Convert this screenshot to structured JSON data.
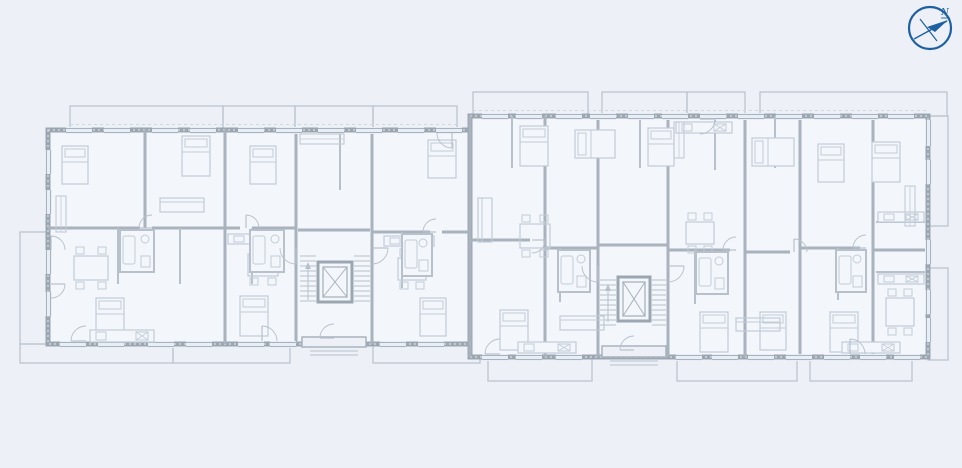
{
  "compass": {
    "label": "N"
  },
  "colors": {
    "bg": "#edf1f7",
    "room": "#f3f6fb",
    "wallOuter": "#9ca6b1",
    "wallInner": "#a9b2bd",
    "partition": "#b7c0cb",
    "furniture": "#c3ccd7",
    "balcony": "#b9c1cc",
    "windowFill": "#e8eef5",
    "windowLine": "#a9b2bd",
    "dash": "#cfd7e0",
    "stair": "#b7c0cb",
    "compass": "#1e5fa2"
  },
  "plan": {
    "wings": [
      {
        "x": 48,
        "y": 130,
        "w": 422,
        "h": 214
      },
      {
        "x": 470,
        "y": 116,
        "w": 458,
        "h": 241
      }
    ],
    "balconies": [
      [
        70,
        106,
        153,
        24
      ],
      [
        223,
        106,
        72,
        24
      ],
      [
        295,
        106,
        78,
        24
      ],
      [
        373,
        106,
        84,
        24
      ],
      [
        473,
        92,
        115,
        24
      ],
      [
        602,
        92,
        85,
        24
      ],
      [
        687,
        92,
        58,
        24
      ],
      [
        760,
        92,
        187,
        24
      ],
      [
        928,
        116,
        20,
        110
      ],
      [
        928,
        268,
        20,
        92
      ],
      [
        20,
        344,
        153,
        19
      ],
      [
        173,
        344,
        117,
        19
      ],
      [
        373,
        344,
        107,
        19
      ],
      [
        20,
        232,
        28,
        112
      ],
      [
        488,
        357,
        104,
        24
      ],
      [
        677,
        357,
        120,
        24
      ],
      [
        810,
        357,
        102,
        24
      ]
    ],
    "overhang_dashes": [
      [
        70,
        124.5,
        457,
        124.5
      ],
      [
        473,
        110.5,
        926,
        110.5
      ]
    ],
    "partitions_thick": [
      [
        145,
        130,
        145,
        228
      ],
      [
        225,
        130,
        225,
        344
      ],
      [
        296,
        130,
        296,
        344
      ],
      [
        372,
        130,
        372,
        344
      ],
      [
        470,
        116,
        470,
        357
      ],
      [
        545,
        116,
        545,
        357
      ],
      [
        598,
        116,
        598,
        357
      ],
      [
        668,
        116,
        668,
        357
      ],
      [
        745,
        116,
        745,
        357
      ],
      [
        800,
        116,
        800,
        357
      ],
      [
        873,
        116,
        873,
        357
      ],
      [
        48,
        228,
        140,
        228
      ],
      [
        152,
        228,
        240,
        228
      ],
      [
        252,
        228,
        296,
        228
      ],
      [
        372,
        232,
        430,
        232
      ],
      [
        442,
        232,
        470,
        232
      ],
      [
        298,
        230,
        370,
        230
      ],
      [
        598,
        245,
        668,
        245
      ],
      [
        470,
        240,
        530,
        240
      ],
      [
        545,
        248,
        598,
        248
      ],
      [
        668,
        250,
        730,
        250
      ],
      [
        745,
        252,
        790,
        252
      ],
      [
        800,
        248,
        860,
        248
      ],
      [
        873,
        250,
        928,
        250
      ]
    ],
    "partitions_thin": [
      [
        118,
        228,
        118,
        284
      ],
      [
        180,
        228,
        180,
        284
      ],
      [
        252,
        228,
        252,
        284
      ],
      [
        402,
        232,
        402,
        288
      ],
      [
        560,
        248,
        560,
        302
      ],
      [
        695,
        250,
        695,
        304
      ],
      [
        838,
        248,
        838,
        300
      ],
      [
        340,
        134,
        340,
        190
      ],
      [
        512,
        116,
        512,
        168
      ],
      [
        640,
        116,
        640,
        168
      ],
      [
        715,
        116,
        715,
        170
      ],
      [
        775,
        116,
        775,
        168
      ],
      [
        876,
        222,
        925,
        222
      ],
      [
        876,
        272,
        925,
        272
      ]
    ],
    "windows_h": [
      [
        66,
        127,
        26
      ],
      [
        104,
        127,
        26
      ],
      [
        152,
        127,
        26
      ],
      [
        190,
        127,
        26
      ],
      [
        238,
        127,
        26
      ],
      [
        276,
        127,
        26
      ],
      [
        318,
        127,
        26
      ],
      [
        356,
        127,
        26
      ],
      [
        398,
        127,
        26
      ],
      [
        436,
        127,
        26
      ],
      [
        60,
        341,
        26
      ],
      [
        98,
        341,
        26
      ],
      [
        148,
        341,
        26
      ],
      [
        186,
        341,
        26
      ],
      [
        238,
        341,
        26
      ],
      [
        270,
        341,
        26
      ],
      [
        380,
        341,
        26
      ],
      [
        418,
        341,
        26
      ],
      [
        482,
        113,
        26
      ],
      [
        516,
        113,
        26
      ],
      [
        556,
        113,
        26
      ],
      [
        590,
        113,
        26
      ],
      [
        628,
        113,
        26
      ],
      [
        662,
        113,
        26
      ],
      [
        700,
        113,
        26
      ],
      [
        738,
        113,
        26
      ],
      [
        776,
        113,
        26
      ],
      [
        814,
        113,
        26
      ],
      [
        852,
        113,
        26
      ],
      [
        888,
        113,
        26
      ],
      [
        482,
        354,
        26
      ],
      [
        516,
        354,
        26
      ],
      [
        556,
        354,
        26
      ],
      [
        676,
        354,
        26
      ],
      [
        712,
        354,
        26
      ],
      [
        748,
        354,
        26
      ],
      [
        786,
        354,
        26
      ],
      [
        824,
        354,
        26
      ],
      [
        860,
        354,
        26
      ],
      [
        894,
        354,
        26
      ]
    ],
    "windows_v": [
      [
        45,
        150,
        24
      ],
      [
        45,
        190,
        24
      ],
      [
        45,
        250,
        24
      ],
      [
        45,
        292,
        24
      ],
      [
        925,
        120,
        26
      ],
      [
        925,
        160,
        24
      ],
      [
        925,
        240,
        24
      ],
      [
        925,
        290,
        24
      ],
      [
        925,
        318,
        24
      ]
    ],
    "recesses": [
      [
        302,
        337,
        64,
        10
      ],
      [
        602,
        346,
        64,
        11
      ]
    ],
    "elevators": [
      [
        318,
        262,
        34,
        40
      ],
      [
        618,
        277,
        32,
        44
      ]
    ],
    "stair_flights": [
      {
        "x1": 300,
        "x2": 316,
        "y0": 256,
        "y1": 302,
        "step": 5
      },
      {
        "x1": 354,
        "x2": 370,
        "y0": 256,
        "y1": 302,
        "step": 5
      },
      {
        "x1": 600,
        "x2": 616,
        "y0": 280,
        "y1": 326,
        "step": 5
      },
      {
        "x1": 652,
        "x2": 666,
        "y0": 280,
        "y1": 326,
        "step": 5
      }
    ],
    "stair_arrows": [
      [
        308,
        300,
        262
      ],
      [
        608,
        322,
        284
      ]
    ],
    "bathrooms": [
      [
        120,
        230,
        34,
        42
      ],
      [
        250,
        230,
        34,
        42
      ],
      [
        402,
        234,
        30,
        42
      ],
      [
        558,
        250,
        32,
        42
      ],
      [
        696,
        252,
        32,
        42
      ],
      [
        836,
        250,
        30,
        42
      ]
    ],
    "beds": [
      [
        62,
        146,
        26,
        38
      ],
      [
        182,
        136,
        28,
        40
      ],
      [
        250,
        146,
        26,
        38
      ],
      [
        428,
        140,
        28,
        38
      ],
      [
        96,
        298,
        28,
        38
      ],
      [
        240,
        296,
        28,
        40
      ],
      [
        420,
        298,
        26,
        38
      ],
      [
        520,
        126,
        28,
        40
      ],
      [
        575,
        130,
        40,
        28
      ],
      [
        648,
        128,
        26,
        38
      ],
      [
        752,
        138,
        42,
        28
      ],
      [
        818,
        144,
        26,
        38
      ],
      [
        872,
        142,
        28,
        40
      ],
      [
        500,
        310,
        28,
        40
      ],
      [
        700,
        312,
        28,
        40
      ],
      [
        760,
        312,
        26,
        38
      ],
      [
        830,
        312,
        28,
        40
      ]
    ],
    "tables": [
      [
        74,
        256,
        34,
        24
      ],
      [
        248,
        254,
        30,
        22
      ],
      [
        398,
        258,
        28,
        22
      ],
      [
        520,
        224,
        30,
        24
      ],
      [
        686,
        222,
        28,
        22
      ],
      [
        886,
        298,
        28,
        28
      ]
    ],
    "sofas": [
      [
        160,
        198,
        44,
        14
      ],
      [
        478,
        198,
        14,
        44
      ],
      [
        560,
        316,
        44,
        14
      ],
      [
        736,
        318,
        44,
        13
      ]
    ],
    "counters": [
      [
        90,
        330,
        64,
        12
      ],
      [
        228,
        234,
        56,
        10
      ],
      [
        384,
        236,
        50,
        10
      ],
      [
        518,
        342,
        58,
        11
      ],
      [
        676,
        122,
        56,
        11
      ],
      [
        842,
        342,
        58,
        11
      ],
      [
        878,
        212,
        46,
        10
      ],
      [
        878,
        274,
        46,
        10
      ]
    ],
    "wardrobes": [
      [
        300,
        134,
        44,
        10
      ],
      [
        674,
        122,
        10,
        36
      ],
      [
        56,
        196,
        10,
        36
      ],
      [
        905,
        186,
        10,
        40
      ]
    ],
    "doors": [
      [
        296,
        248,
        16,
        90,
        180
      ],
      [
        372,
        248,
        16,
        0,
        90
      ],
      [
        334,
        338,
        14,
        180,
        270
      ],
      [
        634,
        350,
        14,
        180,
        270
      ],
      [
        598,
        266,
        16,
        90,
        180
      ],
      [
        668,
        266,
        16,
        0,
        90
      ],
      [
        86,
        341,
        15,
        180,
        270
      ],
      [
        262,
        341,
        15,
        270,
        360
      ],
      [
        500,
        354,
        15,
        180,
        270
      ],
      [
        850,
        354,
        15,
        270,
        360
      ],
      [
        700,
        119,
        15,
        0,
        90
      ],
      [
        452,
        133,
        15,
        90,
        180
      ],
      [
        152,
        228,
        13,
        180,
        270
      ],
      [
        246,
        228,
        13,
        270,
        360
      ],
      [
        436,
        232,
        13,
        180,
        270
      ],
      [
        532,
        240,
        13,
        0,
        90
      ],
      [
        736,
        250,
        13,
        180,
        270
      ],
      [
        794,
        252,
        13,
        270,
        360
      ],
      [
        866,
        248,
        13,
        180,
        270
      ],
      [
        51,
        250,
        14,
        270,
        360
      ],
      [
        51,
        284,
        14,
        0,
        90
      ]
    ]
  }
}
